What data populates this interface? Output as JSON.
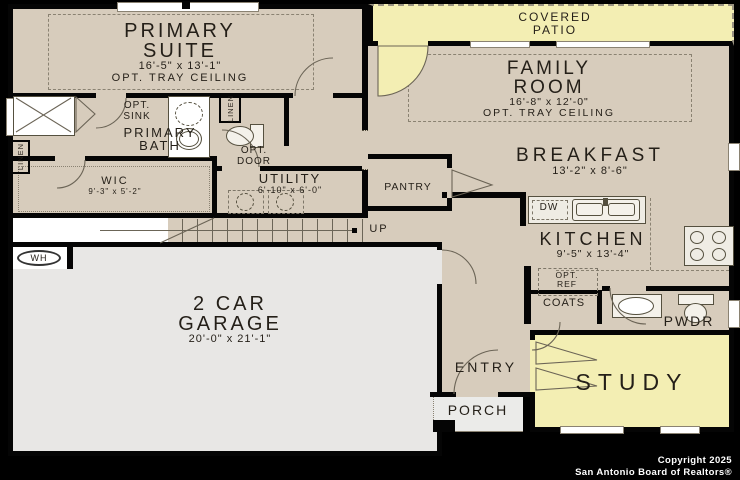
{
  "rooms": {
    "primary_suite": {
      "name": "PRIMARY SUITE",
      "dims": "16'-5\" x 13'-1\"",
      "note": "OPT. TRAY CEILING"
    },
    "covered_patio": {
      "name": "COVERED PATIO"
    },
    "family_room": {
      "name": "FAMILY ROOM",
      "dims": "16'-8\" x 12'-0\"",
      "note": "OPT. TRAY CEILING"
    },
    "breakfast": {
      "name": "BREAKFAST",
      "dims": "13'-2\" x 8'-6\""
    },
    "kitchen": {
      "name": "KITCHEN",
      "dims": "9'-5\" x 13'-4\""
    },
    "primary_bath": {
      "name": "PRIMARY BATH"
    },
    "wic": {
      "name": "WIC",
      "dims": "9'-3\" x 5'-2\""
    },
    "utility": {
      "name": "UTILITY",
      "dims": "6'-10\" x 6'-0\""
    },
    "pantry": {
      "name": "PANTRY"
    },
    "garage": {
      "name": "2 CAR GARAGE",
      "dims": "20'-0\" x 21'-1\""
    },
    "study": {
      "name": "STUDY"
    },
    "entry": {
      "name": "ENTRY"
    },
    "porch": {
      "name": "PORCH"
    },
    "pwdr": {
      "name": "PWDR"
    },
    "coats": {
      "name": "COATS"
    }
  },
  "annotations": {
    "opt_sink": "OPT. SINK",
    "opt_door": "OPT. DOOR",
    "opt_ref": "OPT. REF",
    "linen": "LINEN",
    "up": "UP",
    "dw": "DW",
    "wh": "WH"
  },
  "footer": {
    "copyright": "Copyright 2025",
    "attribution": "San Antonio Board of Realtors®"
  },
  "colors": {
    "background": "#000000",
    "interior": "#d7ccbc",
    "highlight": "#f3eeb3",
    "garage": "#e8e7e5",
    "wall": "#050505",
    "text": "#241f18",
    "footer_text": "#ffffff"
  }
}
